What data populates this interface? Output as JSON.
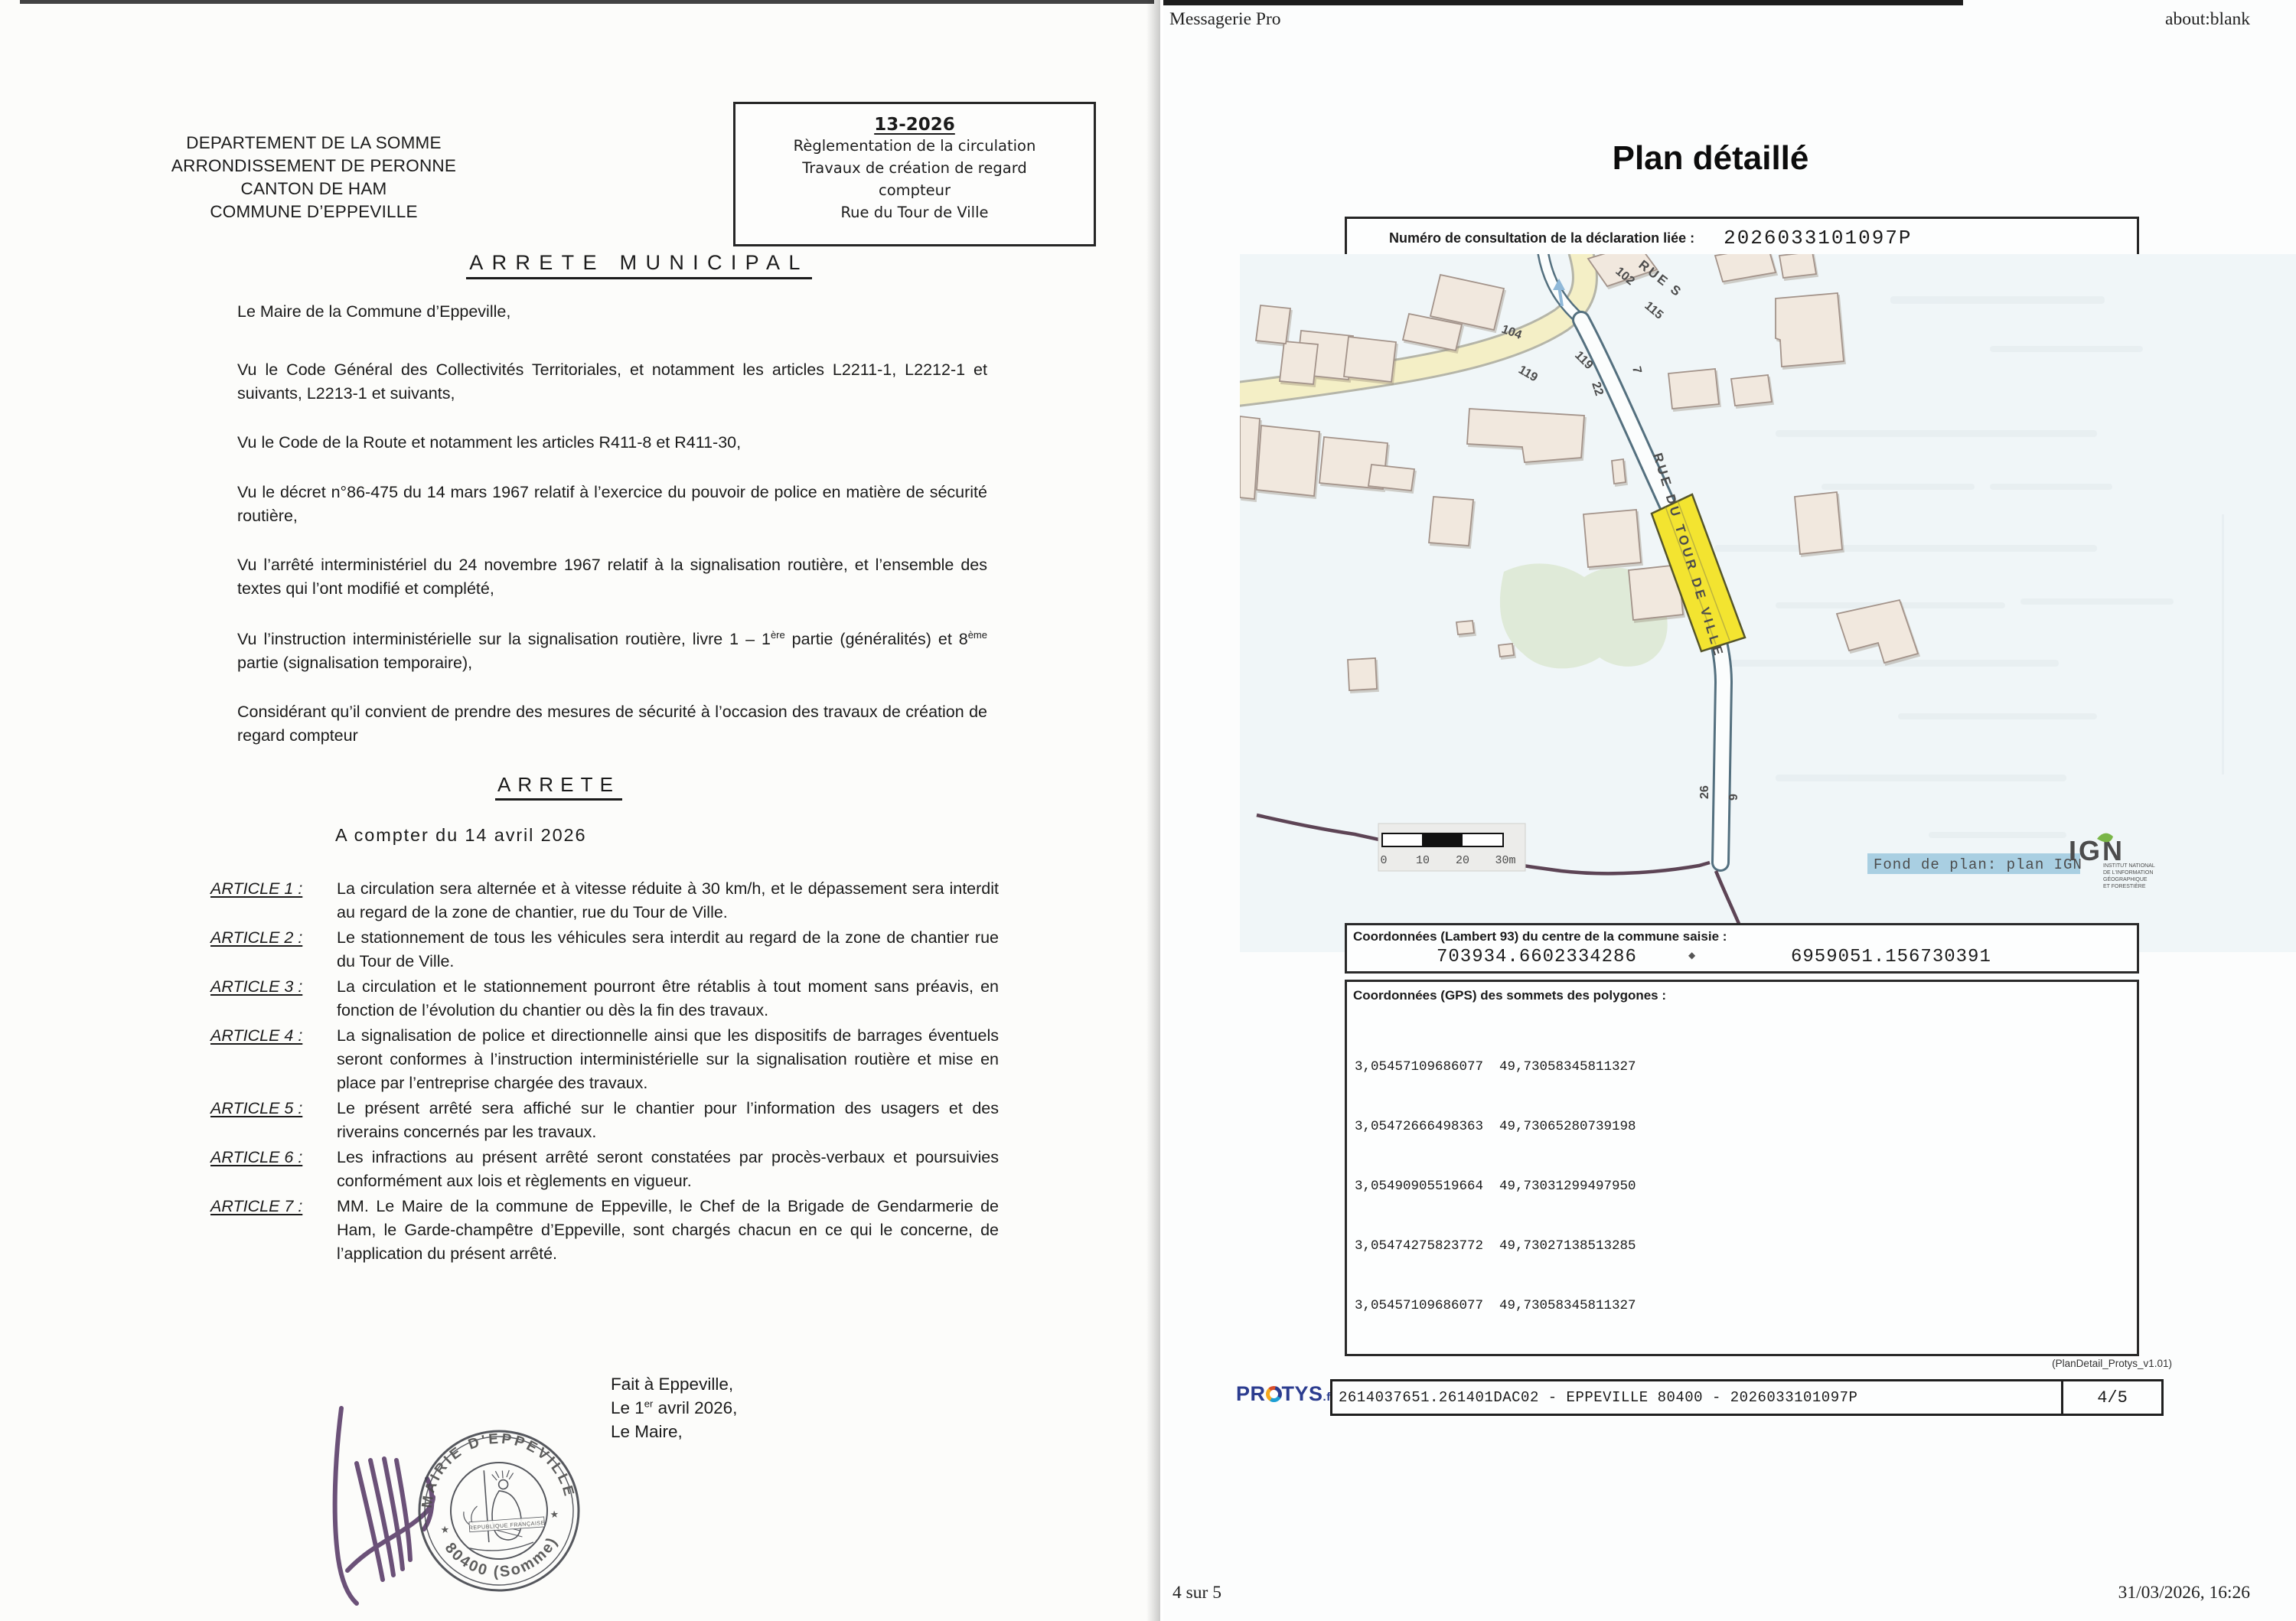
{
  "window": {
    "header_left": "Messagerie Pro",
    "header_right": "about:blank",
    "footer_left": "4 sur 5",
    "footer_right": "31/03/2026, 16:26"
  },
  "arrete": {
    "commune_block": [
      "DEPARTEMENT DE LA SOMME",
      "ARRONDISSEMENT DE PERONNE",
      "CANTON DE HAM",
      "COMMUNE D’EPPEVILLE"
    ],
    "ref_box": {
      "number": "13-2026",
      "lines": [
        "Règlementation de la circulation",
        "Travaux de création de regard",
        "compteur",
        "Rue du Tour de Ville"
      ]
    },
    "title": "ARRETE MUNICIPAL",
    "intro": "Le Maire de la Commune d’Eppeville,",
    "recitals": [
      "Vu le Code Général des Collectivités Territoriales, et notamment les articles L2211-1, L2212-1 et suivants, L2213-1 et suivants,",
      "Vu le Code de la Route et notamment les articles R411-8 et R411-30,",
      "Vu le décret n°86-475 du 14 mars 1967 relatif à l’exercice du pouvoir de police en matière de sécurité routière,",
      "Vu l’arrêté interministériel du 24 novembre 1967 relatif à la signalisation routière, et l’ensemble des textes qui l’ont modifié et complété,"
    ],
    "recital_instruction": {
      "p1": "Vu l’instruction interministérielle sur la signalisation routière, livre 1 – 1",
      "sup1": "ère",
      "p2": " partie (généralités) et 8",
      "sup2": "ème",
      "p3": " partie (signalisation temporaire),"
    },
    "considerant": "Considérant qu’il convient de prendre des mesures de sécurité à l’occasion des travaux de création de regard compteur",
    "arrete_heading": "ARRETE",
    "effective": "A compter du 14 avril 2026",
    "articles": [
      {
        "label": "ARTICLE 1 :",
        "text": "La circulation sera alternée et à vitesse réduite à 30 km/h, et le dépassement sera interdit au regard de la zone de chantier, rue du Tour de Ville."
      },
      {
        "label": "ARTICLE 2 :",
        "text": "Le stationnement de tous les véhicules sera interdit au regard de la zone de chantier rue du Tour de Ville."
      },
      {
        "label": "ARTICLE 3 :",
        "text": "La circulation et le stationnement pourront être rétablis à tout moment sans préavis, en fonction de l’évolution du chantier ou dès la fin des travaux."
      },
      {
        "label": "ARTICLE 4 :",
        "text": "La signalisation de police et directionnelle ainsi que les dispositifs de barrages éventuels seront conformes à l’instruction interministérielle sur la signalisation routière et mise en place par l’entreprise chargée des travaux."
      },
      {
        "label": "ARTICLE 5 :",
        "text": "Le présent arrêté sera affiché sur le chantier pour l’information des usagers et des riverains concernés par les travaux."
      },
      {
        "label": "ARTICLE 6 :",
        "text": "Les infractions au présent arrêté seront constatées par procès-verbaux et poursuivies conformément aux lois et règlements en vigueur."
      },
      {
        "label": "ARTICLE 7 :",
        "text": "MM. Le Maire de la commune de Eppeville, le Chef de la Brigade de Gendarmerie de Ham, le Garde-champêtre d’Eppeville, sont chargés chacun en ce qui le concerne, de l’application du présent arrêté."
      }
    ],
    "closing": {
      "l1": "Fait à Eppeville,",
      "l2a": "Le 1",
      "l2sup": "er",
      "l2b": " avril 2026,",
      "l3": "Le Maire,"
    },
    "stamp": {
      "top": "MAIRIE D'EPPEVILLE",
      "bottom": "80400 (Somme)",
      "center": "REPUBLIQUE FRANÇAISE"
    }
  },
  "plan": {
    "title": "Plan détaillé",
    "consultation": {
      "label": "Numéro de consultation de la déclaration liée :",
      "number": "2026033101097P"
    },
    "map": {
      "street_main": "RUE S",
      "street_vertical": "RUE DU TOUR DE VILLE",
      "numbers": {
        "n102": "102",
        "n115": "115",
        "n104": "104",
        "n119a": "119",
        "n119b": "119",
        "n22": "22",
        "n7": "7",
        "n26": "26",
        "n9": "9"
      },
      "scale": {
        "t0": "0",
        "t1": "10",
        "t2": "20",
        "t3": "30m"
      },
      "attribution": "Fond de plan: plan IGN",
      "ign": {
        "brand": "IGN",
        "tagline": [
          "INSTITUT NATIONAL",
          "DE L'INFORMATION",
          "GÉOGRAPHIQUE",
          "ET FORESTIÈRE"
        ]
      }
    },
    "lambert": {
      "label": "Coordonnées (Lambert 93) du centre de la commune saisie :",
      "x": "703934.6602334286",
      "separator": "◆",
      "y": "6959051.156730391"
    },
    "gps": {
      "label": "Coordonnées (GPS) des sommets des polygones :",
      "points": [
        "3,05457109686077  49,73058345811327",
        "3,05472666498363  49,73065280739198",
        "3,05490905519664  49,73031299497950",
        "3,05474275823772  49,73027138513285",
        "3,05457109686077  49,73058345811327"
      ]
    },
    "version": "(PlanDetail_Protys_v1.01)",
    "protys": {
      "brand_pr": "PR",
      "brand_tys": "TYS",
      "brand_tld": ".fr",
      "reference": "2614037651.261401DAC02 - EPPEVILLE 80400 - 2026033101097P",
      "page": "4/5"
    }
  },
  "colors": {
    "work_zone": "#f3e430",
    "main_road": "#f4efc6",
    "building_fill": "#f1e8de",
    "building_stroke": "#a3938a",
    "street_casing": "#54707f",
    "vegetation": "#dfead8",
    "boundary_purple": "#5d4455",
    "attribution_bg": "#a9cfe2",
    "ign_blue": "#485f6d",
    "ign_green": "#7ab648",
    "protys_blue": "#2b3c8f",
    "signature": "#583a67",
    "stamp_ink": "#43464d"
  }
}
